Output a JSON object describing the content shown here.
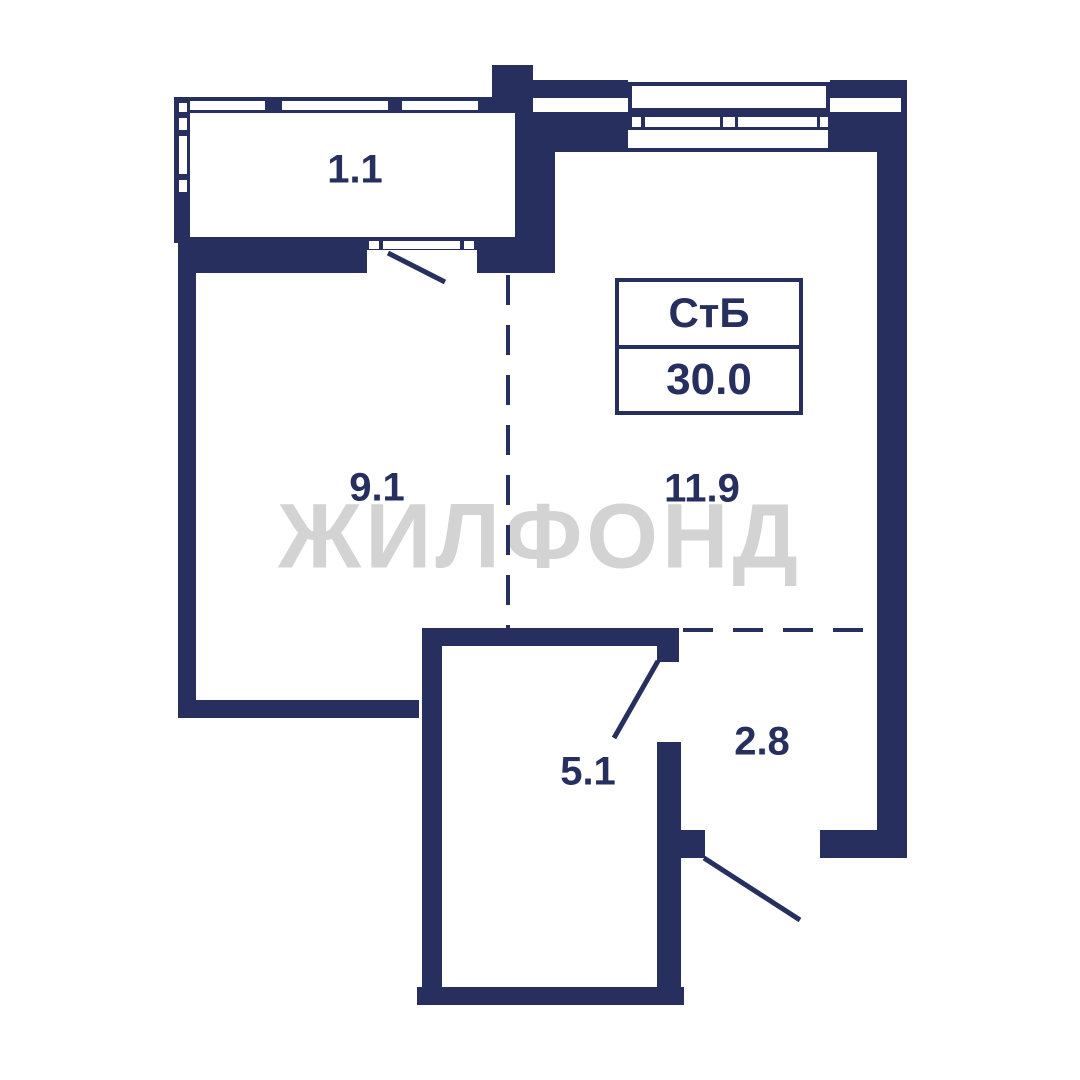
{
  "floorplan": {
    "watermark": "ЖИЛФОНД",
    "unit": {
      "type": "СтБ",
      "area": "30.0"
    },
    "rooms": [
      {
        "name": "balcony",
        "area": "1.1"
      },
      {
        "name": "room-left",
        "area": "9.1"
      },
      {
        "name": "room-right",
        "area": "11.9"
      },
      {
        "name": "bathroom",
        "area": "5.1"
      },
      {
        "name": "hallway",
        "area": "2.8"
      }
    ],
    "colors": {
      "wall": "#262f5e",
      "watermark": "#d3d3d3",
      "background": "#ffffff"
    }
  }
}
